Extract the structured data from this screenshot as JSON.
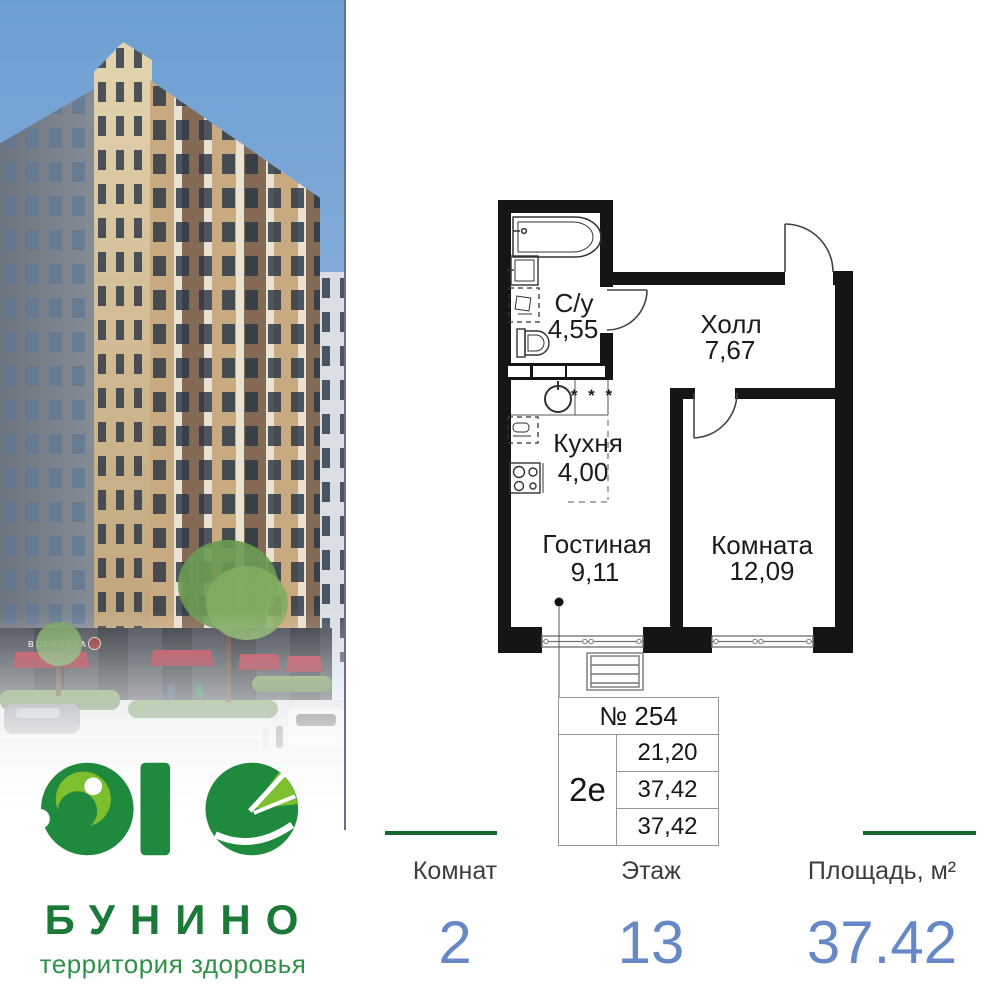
{
  "brand": {
    "logo_mark": "ЭКО",
    "name": "БУНИНО",
    "tagline": "территория здоровья",
    "storefront_sign": "BUCKSSTAR",
    "green_dark": "#1f8a3d",
    "green_light": "#7dbf2f",
    "text_green": "#1c7a39"
  },
  "floor_plan": {
    "wall_color": "#151515",
    "rooms": [
      {
        "name": "С/у",
        "area": "4,55"
      },
      {
        "name": "Холл",
        "area": "7,67"
      },
      {
        "name": "Кухня",
        "area": "4,00"
      },
      {
        "name": "Гостиная",
        "area": "9,11"
      },
      {
        "name": "Комната",
        "area": "12,09"
      }
    ],
    "kitchen_symbol": "* * *"
  },
  "unit_table": {
    "number": "№ 254",
    "type": "2е",
    "areas": [
      "21,20",
      "37,42",
      "37,42"
    ]
  },
  "stats": [
    {
      "label": "Комнат",
      "value": "2"
    },
    {
      "label": "Этаж",
      "value": "13"
    },
    {
      "label": "Площадь, м²",
      "value": "37.42"
    }
  ],
  "colors": {
    "accent_blue": "#6688c6",
    "stat_line_green": "#15672f",
    "awning_red": "#a83540"
  }
}
